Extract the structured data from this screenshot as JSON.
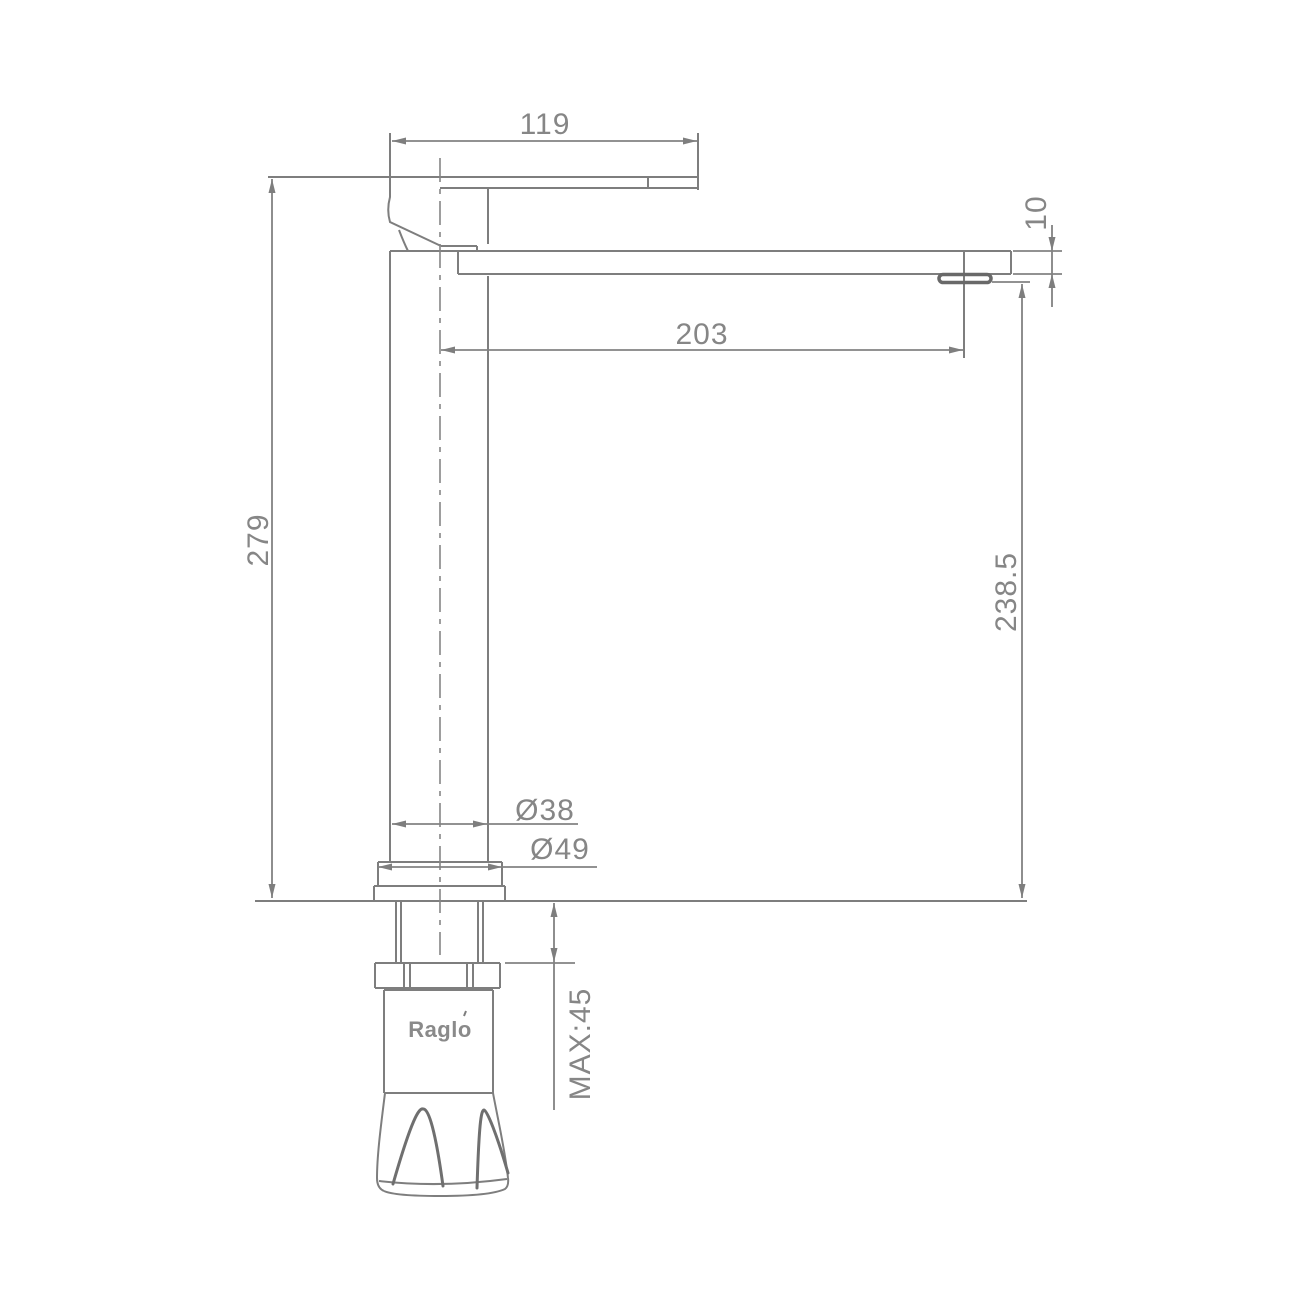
{
  "drawing": {
    "brand": "Raglo",
    "dims": {
      "handle_length": "119",
      "spout_reach": "203",
      "overall_height": "279",
      "outlet_height": "238.5",
      "spout_thickness": "10",
      "body_diameter": "Ø38",
      "base_diameter": "Ø49",
      "max_mount_thickness": "MAX:45"
    },
    "colors": {
      "line": "#7e7e7e",
      "dimension_line": "#828282",
      "text": "#868686",
      "background": "#ffffff"
    }
  }
}
